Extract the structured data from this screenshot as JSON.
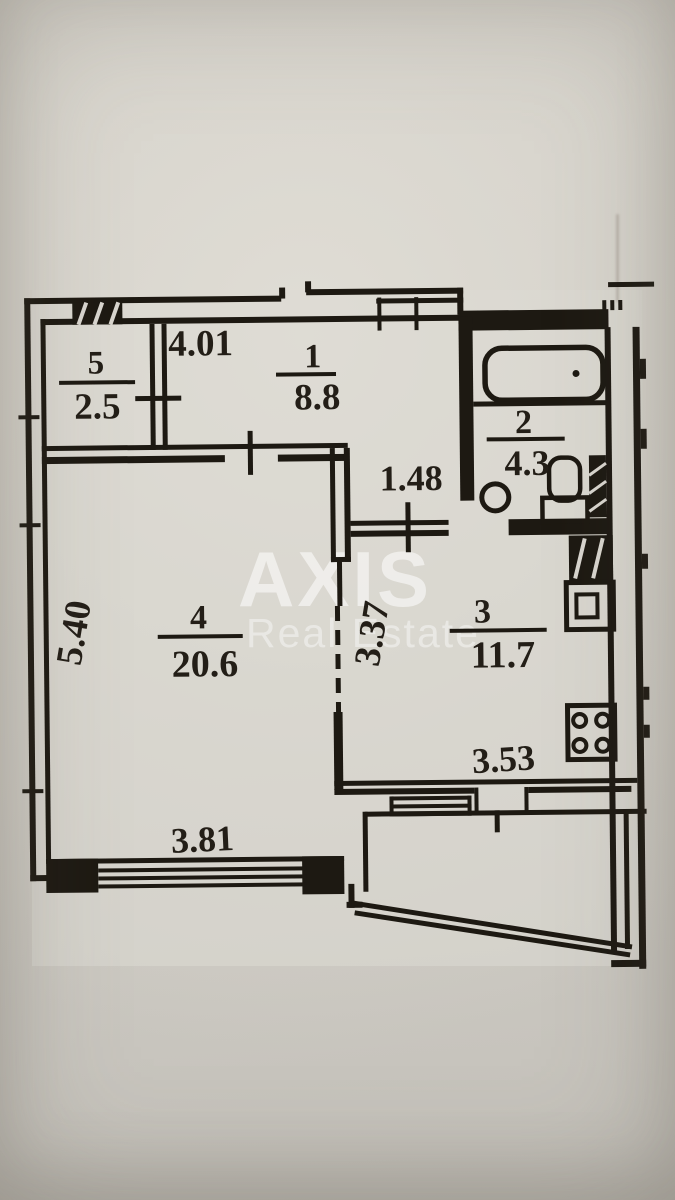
{
  "watermark": {
    "brand": "AXIS",
    "tagline": "Real Estate"
  },
  "rooms": [
    {
      "id": "5",
      "area": "2.5"
    },
    {
      "id": "1",
      "area": "8.8"
    },
    {
      "id": "2",
      "area": "4.3"
    },
    {
      "id": "3",
      "area": "11.7"
    },
    {
      "id": "4",
      "area": "20.6"
    }
  ],
  "dimensions": {
    "hall_width": "4.01",
    "corridor_width": "1.48",
    "living_height": "5.40",
    "living_width": "3.81",
    "kitchen_height": "3.37",
    "kitchen_width": "3.53"
  },
  "colors": {
    "ink": "#1d1912",
    "paper": "#d3d0c9",
    "watermark": "#ffffff"
  }
}
